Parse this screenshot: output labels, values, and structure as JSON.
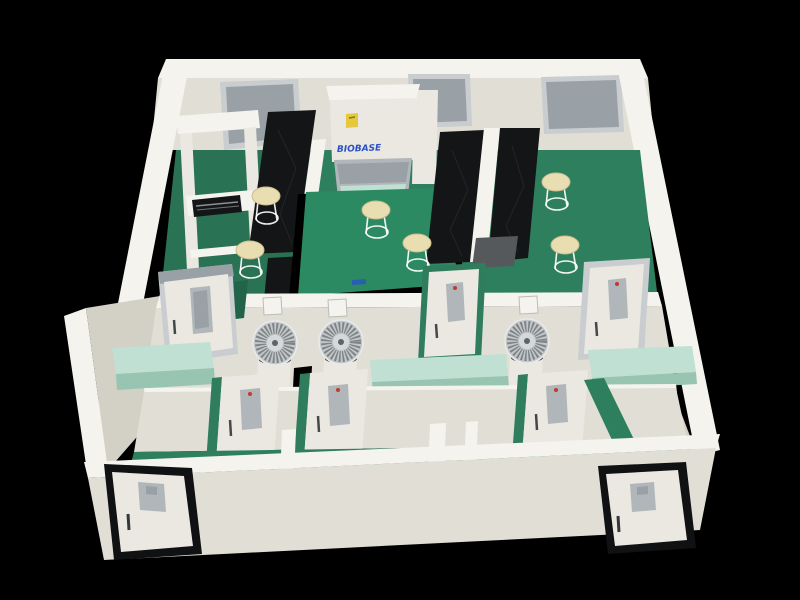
{
  "scene": {
    "description": "3D cutaway render of a laboratory suite with green floors, white partition walls, black lab benches and equipment",
    "labels": {
      "cabinet_brand": "BIOBASE"
    },
    "inventory": {
      "wall_windows": 3,
      "biosafety_cabinet": 1,
      "black_bench_columns": 2,
      "center_island_bench": 1,
      "work_table": 1,
      "lab_stools": 6,
      "fan_units": 3,
      "interior_doors": 6,
      "entry_doors": 2,
      "pale_green_benches": 3
    },
    "colors": {
      "bg": "#000000",
      "wall_cap": "#f4f3ee",
      "wall_face": "#e1dfd5",
      "wall_face_dark": "#d3d0c5",
      "floor_green": "#2e7f5e",
      "floor_green_dark": "#226449",
      "island_top": "#2c8a62",
      "island_side": "#17limit5c44",
      "bench_black": "#141516",
      "bench_gray": "#55595c",
      "bench_pale_top": "#bfe0d2",
      "bench_pale_side": "#98c4b2",
      "stool_top": "#e9ddb2",
      "window_gray": "#9aa1a6",
      "window_frame": "#c9cdd0",
      "door_face": "#eae8e1",
      "door_window": "#b0b6b9",
      "door_frame_green": "#2f7d5c",
      "door_frame_dark": "#101113",
      "brand_blue": "#2b52c4",
      "sticker_yellow": "#e4c93e",
      "fan_silver": "#c3c7c9",
      "red_dot": "#c03a2e"
    }
  }
}
